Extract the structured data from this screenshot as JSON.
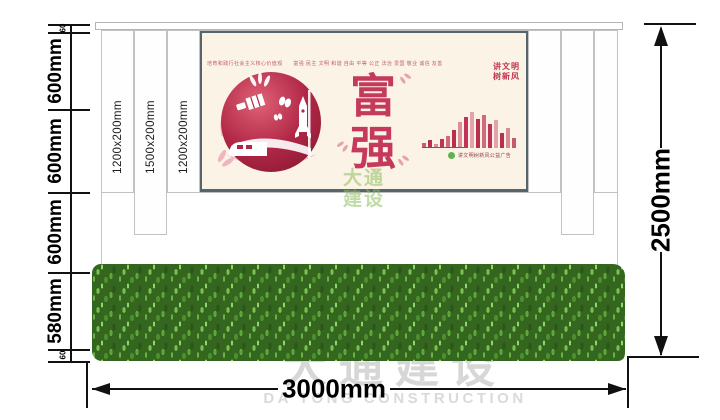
{
  "dimensions": {
    "left_chain": [
      "60",
      "600mm",
      "600mm",
      "600mm",
      "580mm",
      "60"
    ],
    "bottom_total": "3000mm",
    "right_total": "2500mm",
    "slat_sizes": [
      "1200x200mm",
      "1500x200mm",
      "1200x200mm"
    ]
  },
  "poster": {
    "core_values_line": "培育和践行社会主义核心价值观　　富强 民主 文明 和谐 自由 平等 公正 法治 爱国 敬业 诚信 友善",
    "slogan_top": "讲文明",
    "slogan_bottom": "树新风",
    "theme_char_top": "富",
    "theme_char_bottom": "强",
    "footer_caption": "讲文明树新风公益广告",
    "skyline_bars": [
      {
        "h": 5,
        "c": "#c85a6e"
      },
      {
        "h": 8,
        "c": "#b8304c"
      },
      {
        "h": 4,
        "c": "#d98a97"
      },
      {
        "h": 9,
        "c": "#c2335a"
      },
      {
        "h": 12,
        "c": "#d06a7c"
      },
      {
        "h": 18,
        "c": "#b8304c"
      },
      {
        "h": 26,
        "c": "#dd8e9b"
      },
      {
        "h": 31,
        "c": "#c2335a"
      },
      {
        "h": 36,
        "c": "#e3a3ae"
      },
      {
        "h": 29,
        "c": "#b8304c"
      },
      {
        "h": 33,
        "c": "#d06a7c"
      },
      {
        "h": 24,
        "c": "#c2335a"
      },
      {
        "h": 28,
        "c": "#e3a3ae"
      },
      {
        "h": 15,
        "c": "#b8304c"
      },
      {
        "h": 20,
        "c": "#d98a97"
      },
      {
        "h": 10,
        "c": "#c85a6e"
      }
    ]
  },
  "watermarks": {
    "green_top": "大通",
    "green_bottom": "建设",
    "gray_cn": "大通建设",
    "gray_en": "DA TONG CONSTRUCTION"
  },
  "colors": {
    "accent_red": "#c2335a",
    "deep_red": "#b02746",
    "poster_bg": "#fbf3e5",
    "hedge_green": "#35661f",
    "watermark_green": "#8cbe5c",
    "dim_black": "#111111"
  }
}
